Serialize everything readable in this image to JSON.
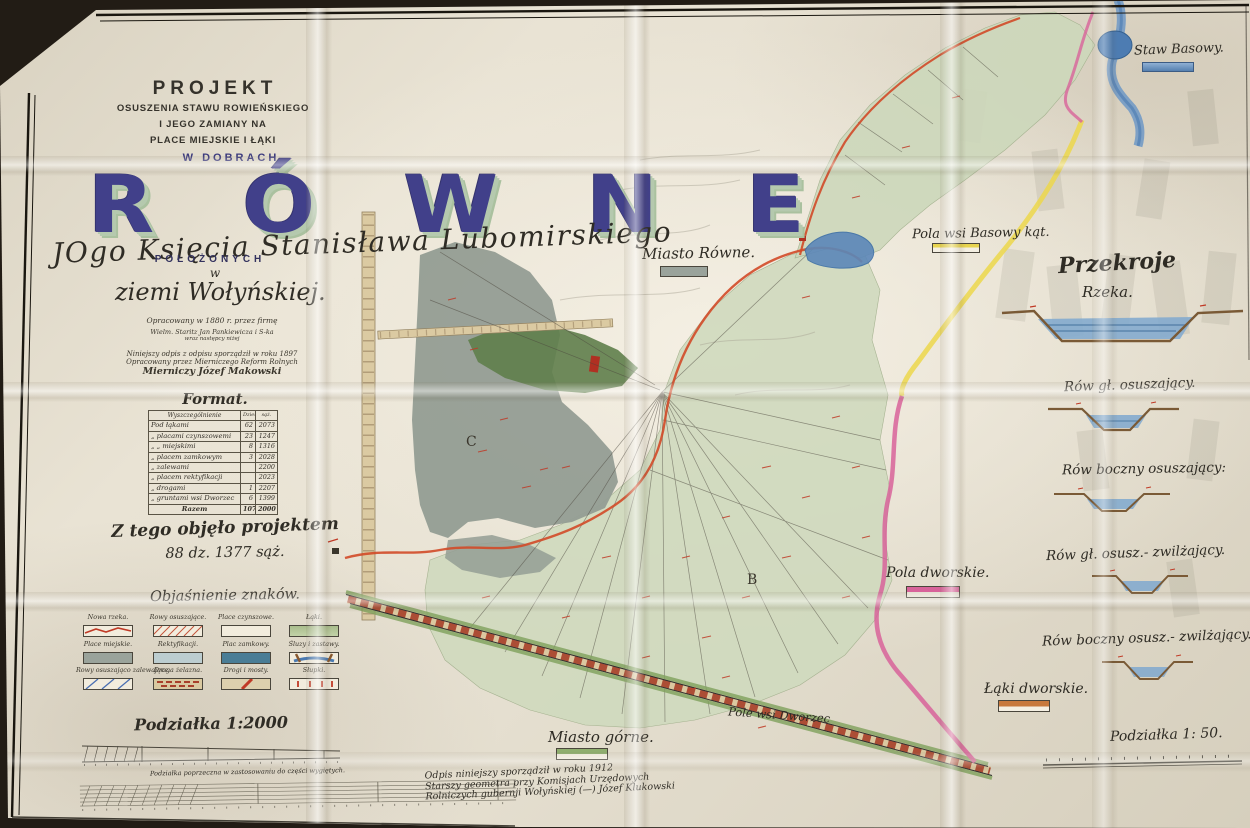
{
  "title_block": {
    "kicker": "PROJEKT",
    "line2": "OSUSZENIA STAWU ROWIEŃSKIEGO",
    "line3": "I JEGO ZAMIANY NA",
    "line4": "PLACE MIEJSKIE I ŁĄKI",
    "line5": "W DOBRACH",
    "estate_name": "RÓWNE",
    "owner": "JOgo Księcia Stanisława Lubomirskiego",
    "located": "POŁOŻONYCH",
    "in_word": "w",
    "region": "ziemi Wołyńskiej.",
    "notes": [
      "Opracowany w 1880 r. przez firmę",
      "Wielm. Staritz Jan Pankiewicza i S-ka",
      "wraz następcy niżej",
      "Niniejszy odpis z odpisu sporządził w roku 1897",
      "Opracowany przez Mierniczego Reform Rolnych",
      "Mierniczy   Józef Makowski"
    ]
  },
  "area_table": {
    "title": "Format.",
    "col_desc": "Wyszczególnienie",
    "col_dzies": "Dzies.",
    "col_saz": "sąż.",
    "rows": [
      {
        "desc": "Pod łąkami",
        "dzies": "62",
        "saz": "2073"
      },
      {
        "desc": "„ placami czynszowemi",
        "dzies": "23",
        "saz": "1247"
      },
      {
        "desc": "„   „   miejskimi",
        "dzies": "8",
        "saz": "1316"
      },
      {
        "desc": "„ placem zamkowym",
        "dzies": "3",
        "saz": "2028"
      },
      {
        "desc": "„ zalewami",
        "dzies": "",
        "saz": "2200"
      },
      {
        "desc": "„ placem rektyfikacji",
        "dzies": "",
        "saz": "2023"
      },
      {
        "desc": "„ drogami",
        "dzies": "1",
        "saz": "2207"
      },
      {
        "desc": "„ gruntami wsi Dworzec",
        "dzies": "6",
        "saz": "1399"
      },
      {
        "desc": "Razem",
        "dzies": "107",
        "saz": "2000"
      }
    ]
  },
  "project_total": {
    "line1": "Z tego objęło projektem",
    "line2": "88 dz. 1377 sąż."
  },
  "legend": {
    "title": "Objaśnienie znaków.",
    "items": [
      {
        "label": "Nowa rzeka."
      },
      {
        "label": "Rowy osuszające."
      },
      {
        "label": "Place czynszowe."
      },
      {
        "label": "Łąki."
      },
      {
        "label": "Place miejskie."
      },
      {
        "label": "Rektyfikacji."
      },
      {
        "label": "Plac zamkowy."
      },
      {
        "label": "Śluzy i zastawy."
      },
      {
        "label": "Rowy osuszająco zalewające."
      },
      {
        "label": "Droga żelazna."
      },
      {
        "label": "Drogi i mosty."
      },
      {
        "label": "Słupki."
      }
    ]
  },
  "scale_main": {
    "title": "Podziałka 1:2000",
    "caption": "Podziałka poprzeczna w zastosowaniu do części wygiętych."
  },
  "sections": {
    "title": "Przekroje",
    "river_label": "Rzeka.",
    "items": [
      "Rów gł. osuszający.",
      "Rów boczny osuszający:",
      "Rów gł. osusz.- zwilżający.",
      "Rów boczny osusz.- zwilżający."
    ],
    "scale_label": "Podziałka 1: 50."
  },
  "map_labels": {
    "staw_basowy": "Staw Basowy.",
    "pola_basowy": "Pola wsi Basowy kąt.",
    "miasto_rowne": "Miasto Równe.",
    "pola_dworskie": "Pola dworskie.",
    "laki_dworskie": "Łąki dworskie.",
    "miasto_gorne": "Miasto górne.",
    "pole_dworzec": "Pole wsi Dworzec",
    "parcel_b": "B",
    "parcel_c": "C"
  },
  "footnote": {
    "lines": [
      "Odpis niniejszy sporządził w roku 1912",
      "Starszy geometra przy Komisjach Urzędowych",
      "Rolniczych gubernji Wołyńskiej (—) Józef Klukowski"
    ]
  },
  "colors": {
    "accent_blue": "#41408a",
    "bevel_green": "#b5c9ae",
    "meadow_green": "#d0dabe",
    "pond_gray": "#949d94",
    "water_blue": "#5b87b8",
    "line_red": "#d24a28",
    "line_yellow": "#ecd74b",
    "line_pink": "#d8639a",
    "railway_brick": "#a8402a"
  }
}
